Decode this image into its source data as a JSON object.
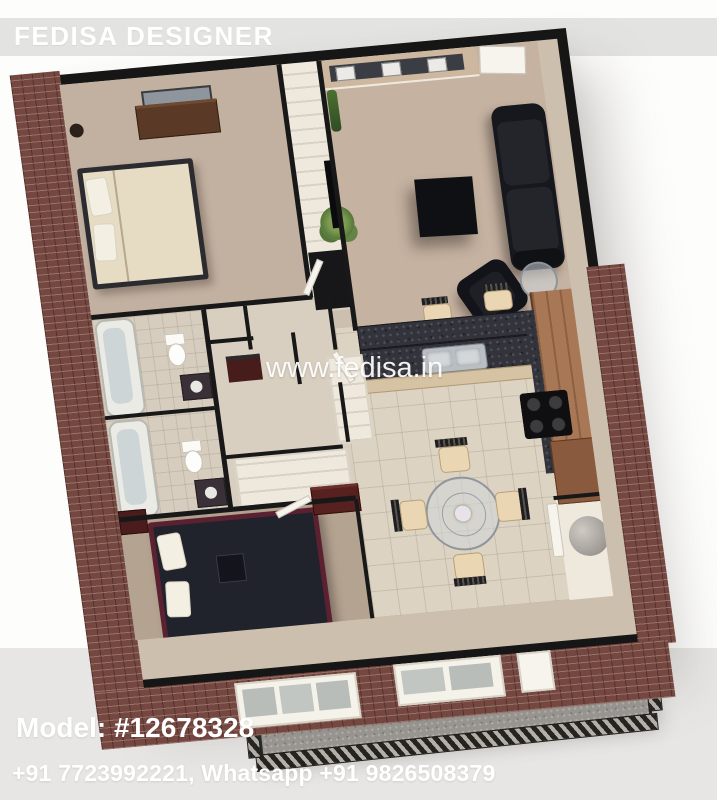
{
  "branding": {
    "designer_banner": "FEDISA DESIGNER",
    "watermark": "www.fedisa.in",
    "model_number": "Model: #12678328",
    "contact": "+91 7723992221, Whatsapp +91 9826508379"
  },
  "colors": {
    "banner_bg": "#e3e3e2",
    "overlay_text": "#ffffff",
    "wall_top": "#181818",
    "brick_exterior": "#744740",
    "carpet_master_bedroom": "#c2b0a0",
    "carpet_living_room": "#c6b2a1",
    "carpet_bedroom2": "#b5a391",
    "kitchen_tile": "#dcd3c3",
    "granite_counter": "#33333c",
    "kitchen_cabinets": "#a87856",
    "sofa_leather": "#17181d",
    "balcony_concrete": "#9b9894",
    "background_lower": "#e7e6e4"
  },
  "scene": {
    "render_type": "3d-apartment-floor-plan",
    "rooms": [
      "master-bedroom",
      "closet-hall",
      "living-room",
      "bathroom-1",
      "bathroom-2",
      "hallway",
      "kitchen",
      "dining-area",
      "bedroom-2",
      "utility-room",
      "balcony"
    ]
  }
}
